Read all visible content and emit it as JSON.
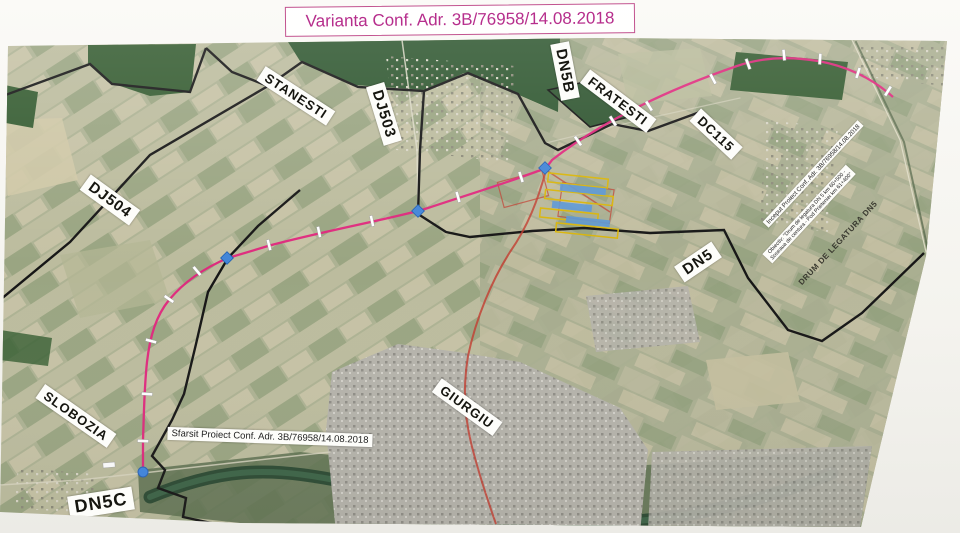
{
  "page": {
    "title": "Varianta Conf. Adr. 3B/76958/14.08.2018"
  },
  "labels": {
    "stanesti": "STANESTI",
    "dj503": "DJ503",
    "dn5b": "DN5B",
    "fratesti": "FRATESTI",
    "dc115": "DC115",
    "dj504": "DJ504",
    "dn5": "DN5",
    "giurgiu": "GIURGIU",
    "slobozia": "SLOBOZIA",
    "dn5c": "DN5C"
  },
  "annotations": {
    "end_label": "Sfarsit Proiect Conf. Adr. 3B/76958/14.08.2018",
    "start_label": "Inceput Proiect Conf. Adr. 3B/76958/14.08.2018",
    "objective_label": "Obiectiv: \"Drum de legatura DN 5 km 60+500 - Soseaua de centura - Pod Prieteniei km 61+400\"",
    "link_road_label": "DRUM DE LEGATURA DN5"
  },
  "colors": {
    "route": "#e0247c",
    "existing_road": "#c23b2e",
    "boundary": "#161616",
    "node_marker": "#4285d8",
    "title_text": "#b62e8c"
  }
}
